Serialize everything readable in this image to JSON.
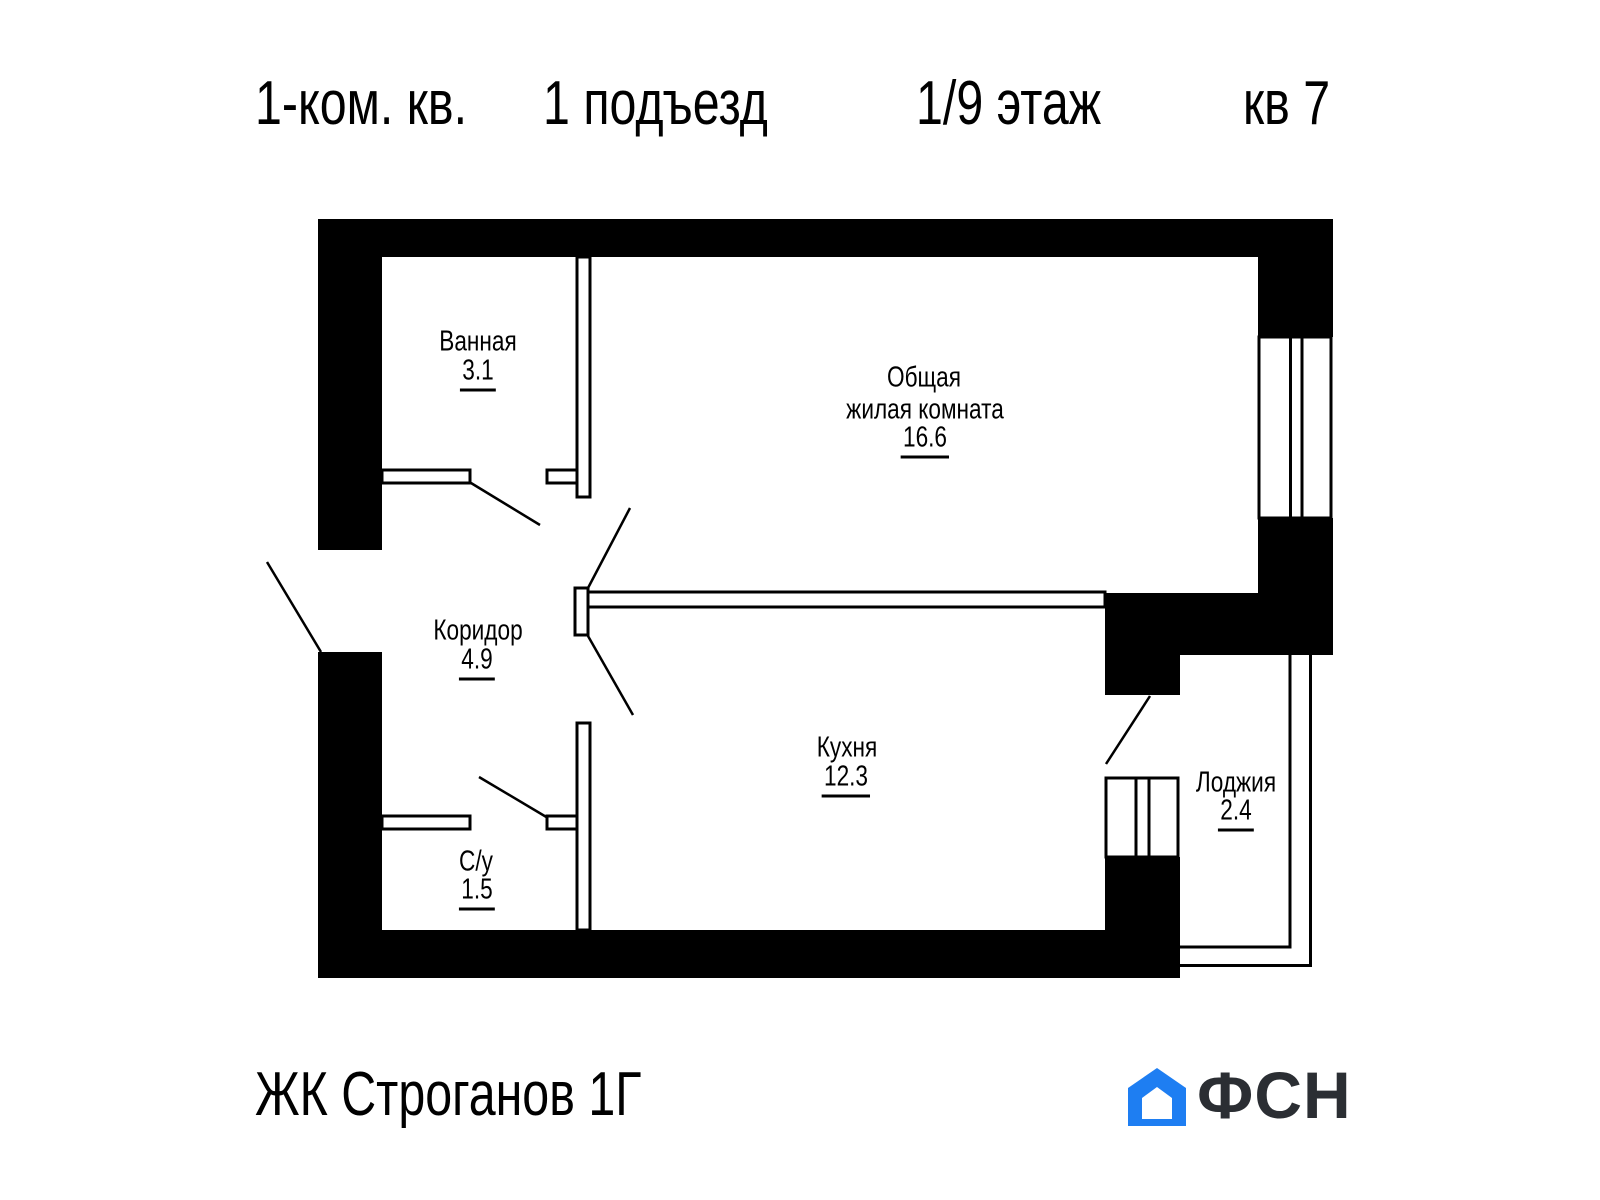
{
  "header": {
    "apartment_type": "1-ком. кв.",
    "entrance": "1 подъезд",
    "floor": "1/9 этаж",
    "unit": "кв 7"
  },
  "rooms": {
    "bathroom": {
      "name": "Ванная",
      "area": "3.1"
    },
    "living": {
      "name_line1": "Общая",
      "name_line2": "жилая комната",
      "area": "16.6"
    },
    "corridor": {
      "name": "Коридор",
      "area": "4.9"
    },
    "kitchen": {
      "name": "Кухня",
      "area": "12.3"
    },
    "wc": {
      "name": "С/у",
      "area": "1.5"
    },
    "loggia": {
      "name": "Лоджия",
      "area": "2.4"
    }
  },
  "footer": {
    "complex_name": "ЖК Строганов 1Г",
    "logo_text": "ФСН"
  },
  "colors": {
    "plan_black": "#000000",
    "logo_blue": "#1e7ef2",
    "logo_text_color": "#2b2e33"
  }
}
